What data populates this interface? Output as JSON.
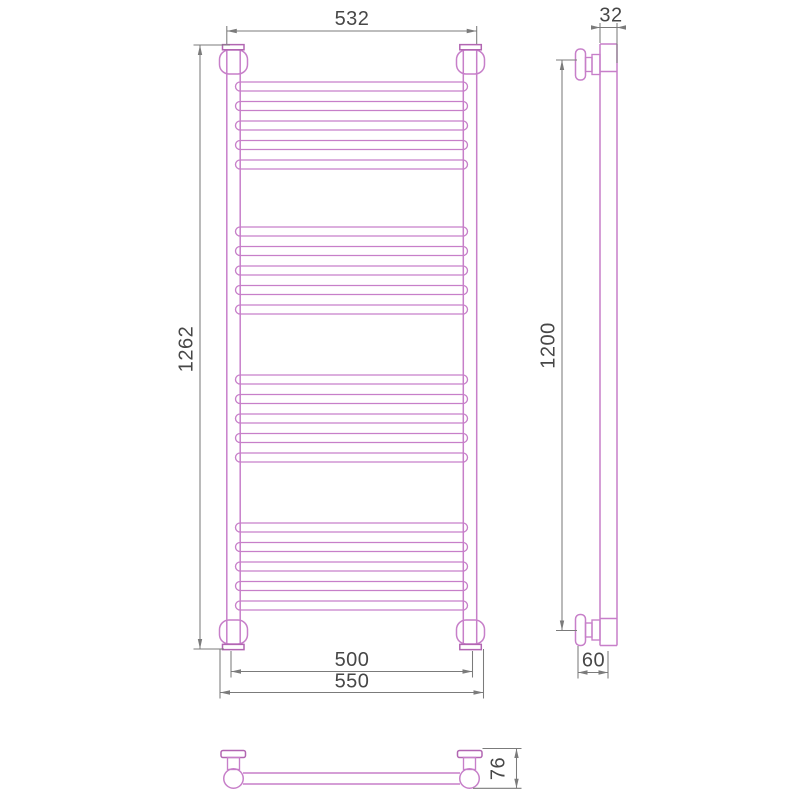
{
  "drawing": {
    "colors": {
      "outline": "#c77fc9",
      "outline_dark": "#b266b2",
      "dim_line": "#7b7b7b",
      "dim_text": "#474747",
      "bg": "#ffffff"
    },
    "views": {
      "front": {
        "width_top": "532",
        "height_overall": "1262",
        "width_bottom_centers": "500",
        "width_bottom_overall": "550"
      },
      "side": {
        "depth_top": "32",
        "height_between_mounts": "1200",
        "wall_offset_bottom": "60"
      },
      "plan": {
        "depth": "76"
      }
    },
    "structure": {
      "rung_groups": 4,
      "rungs_per_group": 5,
      "total_rungs": 20
    }
  }
}
